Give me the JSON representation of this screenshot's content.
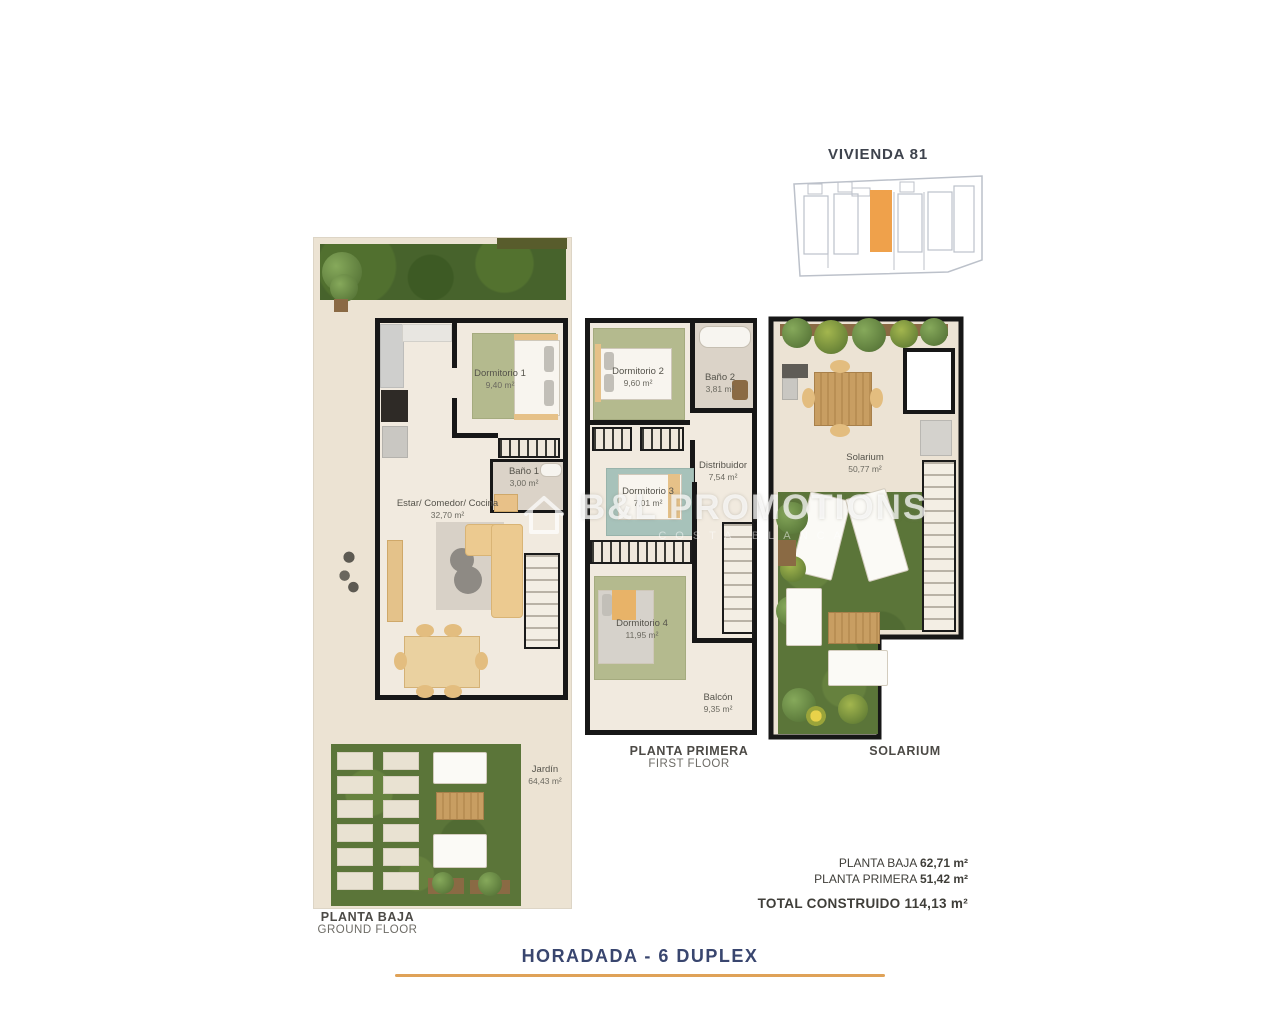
{
  "site_plan": {
    "title": "VIVIENDA 81",
    "highlight_color": "#efa14b"
  },
  "watermark": {
    "brand": "B&L PROMOTIONS",
    "subtitle": "COSTA BLANCA",
    "logo_icon": "house-icon"
  },
  "ground_floor": {
    "caption_es": "PLANTA BAJA",
    "caption_en": "GROUND FLOOR",
    "rooms": {
      "dormitorio1": {
        "name": "Dormitorio 1",
        "area": "9,40 m²"
      },
      "bano1": {
        "name": "Baño 1",
        "area": "3,00 m²"
      },
      "estar": {
        "name": "Estar/ Comedor/ Cocina",
        "area": "32,70 m²"
      },
      "jardin": {
        "name": "Jardín",
        "area": "64,43 m²"
      }
    }
  },
  "first_floor": {
    "caption_es": "PLANTA PRIMERA",
    "caption_en": "FIRST FLOOR",
    "rooms": {
      "dormitorio2": {
        "name": "Dormitorio 2",
        "area": "9,60 m²"
      },
      "bano2": {
        "name": "Baño 2",
        "area": "3,81 m²"
      },
      "distribuidor": {
        "name": "Distribuidor",
        "area": "7,54 m²"
      },
      "dormitorio3": {
        "name": "Dormitorio 3",
        "area": "7,01 m²"
      },
      "dormitorio4": {
        "name": "Dormitorio 4",
        "area": "11,95 m²"
      },
      "balcon": {
        "name": "Balcón",
        "area": "9,35 m²"
      }
    }
  },
  "solarium": {
    "caption": "SOLARIUM",
    "rooms": {
      "solarium": {
        "name": "Solarium",
        "area": "50,77 m²"
      }
    }
  },
  "summary": {
    "lines": [
      {
        "label": "PLANTA BAJA",
        "value": "62,71 m²"
      },
      {
        "label": "PLANTA PRIMERA",
        "value": "51,42 m²"
      }
    ],
    "total_label": "TOTAL CONSTRUIDO",
    "total_value": "114,13 m²"
  },
  "footer": {
    "title": "HORADADA - 6 DUPLEX",
    "accent_color": "#dfa258",
    "title_color": "#39466f"
  },
  "colors": {
    "wall": "#171717",
    "plot": "#ece3d3",
    "grass": "#5b7539",
    "rug_green": "#b4ba8e",
    "rug_teal": "#a7c2ba"
  }
}
